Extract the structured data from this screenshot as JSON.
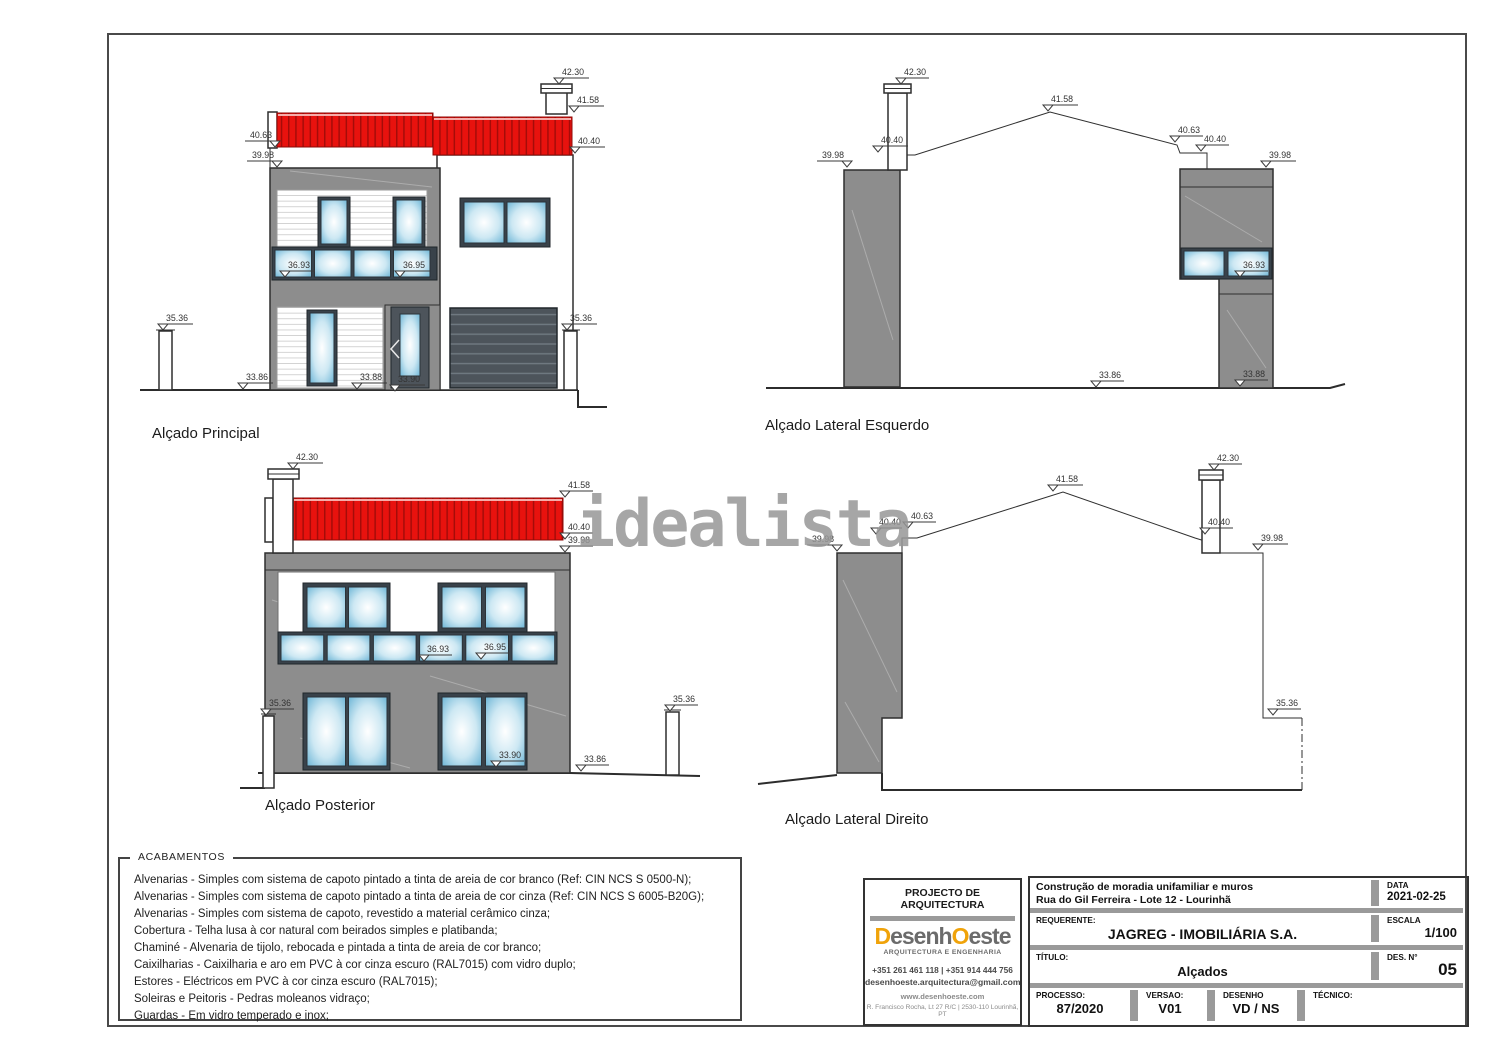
{
  "sheet": {
    "watermark": "idealista",
    "captions": {
      "principal": "Alçado Principal",
      "esquerdo": "Alçado Lateral Esquerdo",
      "posterior": "Alçado Posterior",
      "direito": "Alçado Lateral Direito"
    },
    "dims": {
      "principal": [
        "42.30",
        "41.58",
        "40.63",
        "40.40",
        "39.98",
        "36.93",
        "36.95",
        "35.36",
        "35.36",
        "33.86",
        "33.88",
        "33.90"
      ],
      "esquerdo": [
        "42.30",
        "41.58",
        "40.40",
        "39.98",
        "40.63",
        "40.40",
        "39.98",
        "36.93",
        "33.86",
        "33.88"
      ],
      "posterior": [
        "42.30",
        "41.58",
        "40.40",
        "39.98",
        "36.93",
        "36.95",
        "35.36",
        "35.36",
        "33.90",
        "33.86"
      ],
      "direito": [
        "42.30",
        "41.58",
        "40.63",
        "40.40",
        "39.98",
        "40.40",
        "39.98",
        "35.36"
      ]
    }
  },
  "acabamentos": {
    "title": "ACABAMENTOS",
    "items": [
      "Alvenarias - Simples com sistema de capoto pintado a tinta de areia de cor branco (Ref: CIN NCS S 0500-N);",
      "Alvenarias - Simples com sistema de capoto pintado a tinta de areia de cor cinza (Ref: CIN NCS S 6005-B20G);",
      "Alvenarias - Simples com sistema de capoto, revestido a material cerâmico cinza;",
      "Cobertura - Telha lusa à cor natural com beirados simples e platibanda;",
      "Chaminé - Alvenaria de tijolo, rebocada e pintada a tinta de areia de cor branco;",
      "Caixilharias - Caixilharia e aro em PVC à cor cinza escuro (RAL7015) com vidro duplo;",
      "Estores - Eléctricos em PVC à cor cinza escuro (RAL7015);",
      "Soleiras e Peitoris - Pedras moleanos vidraço;",
      "Guardas - Em vidro temperado e inox;"
    ]
  },
  "titleblock": {
    "architecture": {
      "header": "PROJECTO DE ARQUITECTURA",
      "logo_d": "D",
      "logo_mid": "esenh",
      "logo_o": "O",
      "logo_end": "este",
      "logo_sub": "ARQUITECTURA E ENGENHARIA",
      "phone": "+351 261 461 118  |  +351 914 444 756",
      "email": "desenhoeste.arquitectura@gmail.com",
      "website": "www.desenhoeste.com",
      "address": "R. Francisco Rocha, Lt 27 R/C  |  2530-110 Lourinhã, PT"
    },
    "project": {
      "obra_line1": "Construção de moradia unifamiliar e muros",
      "obra_line2": "Rua do Gil Ferreira - Lote 12 - Lourinhã",
      "requerente_label": "REQUERENTE:",
      "requerente_value": "JAGREG - IMOBILIÁRIA S.A.",
      "titulo_label": "TÍTULO:",
      "titulo_value": "Alçados",
      "processo_label": "PROCESSO:",
      "processo_value": "87/2020",
      "versao_label": "VERSAO:",
      "versao_value": "V01",
      "desenho_label": "DESENHO",
      "desenho_value": "VD / NS",
      "tecnico_label": "TÉCNICO:",
      "tecnico_value": "",
      "data_label": "DATA",
      "data_value": "2021-02-25",
      "escala_label": "ESCALA",
      "escala_value": "1/100",
      "desn_label": "DES. N°",
      "desn_value": "05"
    }
  },
  "colors": {
    "roof_red": "#e8120e",
    "wall_gray": "#8d8d8d",
    "window_frame": "#39424a",
    "glass_blue": "#74b9d8",
    "bar_gray": "#9a9a9a",
    "logo_orange": "#f0a30a"
  }
}
